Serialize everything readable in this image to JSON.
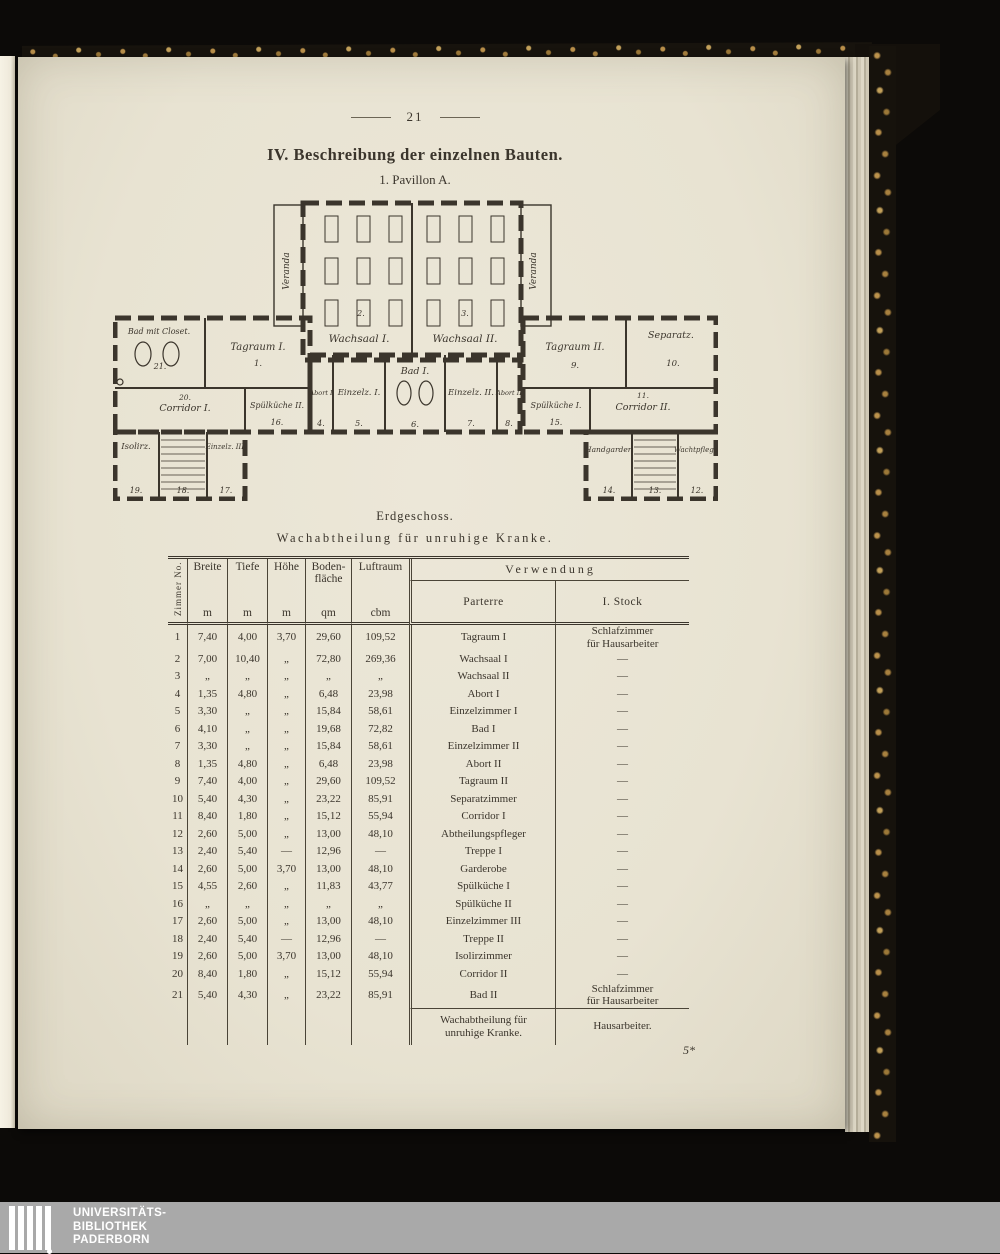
{
  "page": {
    "number": "21",
    "title": "IV. Beschreibung der einzelnen Bauten.",
    "subtitle": "1. Pavillon A."
  },
  "plan": {
    "veranda_left": "Veranda",
    "veranda_right": "Veranda",
    "wachsaal1": "Wachsaal I.",
    "wachsaal1_no": "2.",
    "wachsaal2": "Wachsaal II.",
    "wachsaal2_no": "3.",
    "bad_closet": "Bad mit Closet.",
    "bad_closet_no": "21.",
    "tagraum1": "Tagraum I.",
    "tagraum1_no": "1.",
    "corridor1": "Corridor I.",
    "corridor1_no": "20.",
    "spuelkueche2": "Spülküche II.",
    "spuelkueche2_no": "16.",
    "abort1": "Abort I",
    "abort1_no": "4.",
    "einzelz1": "Einzelz. I.",
    "einzelz1_no": "5.",
    "bad1": "Bad I.",
    "bad1_no": "6.",
    "einzelz2": "Einzelz. II.",
    "einzelz2_no": "7.",
    "abort2": "Abort II",
    "abort2_no": "8.",
    "tagraum2": "Tagraum II.",
    "tagraum2_no": "9.",
    "separatz": "Separatz.",
    "separatz_no": "10.",
    "corridor2": "Corridor II.",
    "corridor2_no": "11.",
    "spuelkueche1": "Spülküche I.",
    "spuelkueche1_no": "15.",
    "isolirz": "Isolirz.",
    "isolirz_no": "19.",
    "treppe_links_no": "18.",
    "einzelz3": "Einzelz. III.",
    "einzelz3_no": "17.",
    "handgarderobe": "Handgarder.",
    "handgarderobe_no": "14.",
    "treppe_rechts_no": "13.",
    "wachtpflege": "Wachtpflege.",
    "wachtpflege_no": "12."
  },
  "captions": {
    "level": "Erdgeschoss.",
    "ward": "Wachabtheilung für unruhige Kranke."
  },
  "table": {
    "col_no": "Zimmer No.",
    "col_breite": "Breite",
    "col_tiefe": "Tiefe",
    "col_hoehe": "Höhe",
    "col_flaeche": "Boden-\nfläche",
    "col_luftraum": "Luftraum",
    "unit_m": "m",
    "unit_qm": "qm",
    "unit_cbm": "cbm",
    "col_verwendung": "Verwendung",
    "col_parterre": "Parterre",
    "col_stock": "I. Stock",
    "rows": [
      {
        "no": "1",
        "breite": "7,40",
        "tiefe": "4,00",
        "hoehe": "3,70",
        "flaeche": "29,60",
        "luftraum": "109,52",
        "parterre": "Tagraum I",
        "stock": "Schlafzimmer\nfür Hausarbeiter"
      },
      {
        "no": "2",
        "breite": "7,00",
        "tiefe": "10,40",
        "hoehe": "„",
        "flaeche": "72,80",
        "luftraum": "269,36",
        "parterre": "Wachsaal I",
        "stock": "—"
      },
      {
        "no": "3",
        "breite": "„",
        "tiefe": "„",
        "hoehe": "„",
        "flaeche": "„",
        "luftraum": "„",
        "parterre": "Wachsaal II",
        "stock": "—"
      },
      {
        "no": "4",
        "breite": "1,35",
        "tiefe": "4,80",
        "hoehe": "„",
        "flaeche": "6,48",
        "luftraum": "23,98",
        "parterre": "Abort I",
        "stock": "—"
      },
      {
        "no": "5",
        "breite": "3,30",
        "tiefe": "„",
        "hoehe": "„",
        "flaeche": "15,84",
        "luftraum": "58,61",
        "parterre": "Einzelzimmer I",
        "stock": "—"
      },
      {
        "no": "6",
        "breite": "4,10",
        "tiefe": "„",
        "hoehe": "„",
        "flaeche": "19,68",
        "luftraum": "72,82",
        "parterre": "Bad I",
        "stock": "—"
      },
      {
        "no": "7",
        "breite": "3,30",
        "tiefe": "„",
        "hoehe": "„",
        "flaeche": "15,84",
        "luftraum": "58,61",
        "parterre": "Einzelzimmer II",
        "stock": "—"
      },
      {
        "no": "8",
        "breite": "1,35",
        "tiefe": "4,80",
        "hoehe": "„",
        "flaeche": "6,48",
        "luftraum": "23,98",
        "parterre": "Abort II",
        "stock": "—"
      },
      {
        "no": "9",
        "breite": "7,40",
        "tiefe": "4,00",
        "hoehe": "„",
        "flaeche": "29,60",
        "luftraum": "109,52",
        "parterre": "Tagraum II",
        "stock": "—"
      },
      {
        "no": "10",
        "breite": "5,40",
        "tiefe": "4,30",
        "hoehe": "„",
        "flaeche": "23,22",
        "luftraum": "85,91",
        "parterre": "Separatzimmer",
        "stock": "—"
      },
      {
        "no": "11",
        "breite": "8,40",
        "tiefe": "1,80",
        "hoehe": "„",
        "flaeche": "15,12",
        "luftraum": "55,94",
        "parterre": "Corridor I",
        "stock": "—"
      },
      {
        "no": "12",
        "breite": "2,60",
        "tiefe": "5,00",
        "hoehe": "„",
        "flaeche": "13,00",
        "luftraum": "48,10",
        "parterre": "Abtheilungspfleger",
        "stock": "—"
      },
      {
        "no": "13",
        "breite": "2,40",
        "tiefe": "5,40",
        "hoehe": "—",
        "flaeche": "12,96",
        "luftraum": "—",
        "parterre": "Treppe I",
        "stock": "—"
      },
      {
        "no": "14",
        "breite": "2,60",
        "tiefe": "5,00",
        "hoehe": "3,70",
        "flaeche": "13,00",
        "luftraum": "48,10",
        "parterre": "Garderobe",
        "stock": "—"
      },
      {
        "no": "15",
        "breite": "4,55",
        "tiefe": "2,60",
        "hoehe": "„",
        "flaeche": "11,83",
        "luftraum": "43,77",
        "parterre": "Spülküche I",
        "stock": "—"
      },
      {
        "no": "16",
        "breite": "„",
        "tiefe": "„",
        "hoehe": "„",
        "flaeche": "„",
        "luftraum": "„",
        "parterre": "Spülküche II",
        "stock": "—"
      },
      {
        "no": "17",
        "breite": "2,60",
        "tiefe": "5,00",
        "hoehe": "„",
        "flaeche": "13,00",
        "luftraum": "48,10",
        "parterre": "Einzelzimmer III",
        "stock": "—"
      },
      {
        "no": "18",
        "breite": "2,40",
        "tiefe": "5,40",
        "hoehe": "—",
        "flaeche": "12,96",
        "luftraum": "—",
        "parterre": "Treppe II",
        "stock": "—"
      },
      {
        "no": "19",
        "breite": "2,60",
        "tiefe": "5,00",
        "hoehe": "3,70",
        "flaeche": "13,00",
        "luftraum": "48,10",
        "parterre": "Isolirzimmer",
        "stock": "—"
      },
      {
        "no": "20",
        "breite": "8,40",
        "tiefe": "1,80",
        "hoehe": "„",
        "flaeche": "15,12",
        "luftraum": "55,94",
        "parterre": "Corridor II",
        "stock": "—"
      },
      {
        "no": "21",
        "breite": "5,40",
        "tiefe": "4,30",
        "hoehe": "„",
        "flaeche": "23,22",
        "luftraum": "85,91",
        "parterre": "Bad II",
        "stock": "Schlafzimmer\nfür Hausarbeiter"
      }
    ],
    "footer_parterre": "Wachabtheilung für\nunruhige Kranke.",
    "footer_stock": "Hausarbeiter."
  },
  "signature": "5*",
  "footer": {
    "line1": "UNIVERSITÄTS-",
    "line2": "BIBLIOTHEK",
    "line3": "PADERBORN"
  },
  "colors": {
    "ink": "#3b352c",
    "paper": "#eae5d6",
    "cover_gold": "#c2a05a",
    "footer_gray": "#a9a9a9"
  }
}
